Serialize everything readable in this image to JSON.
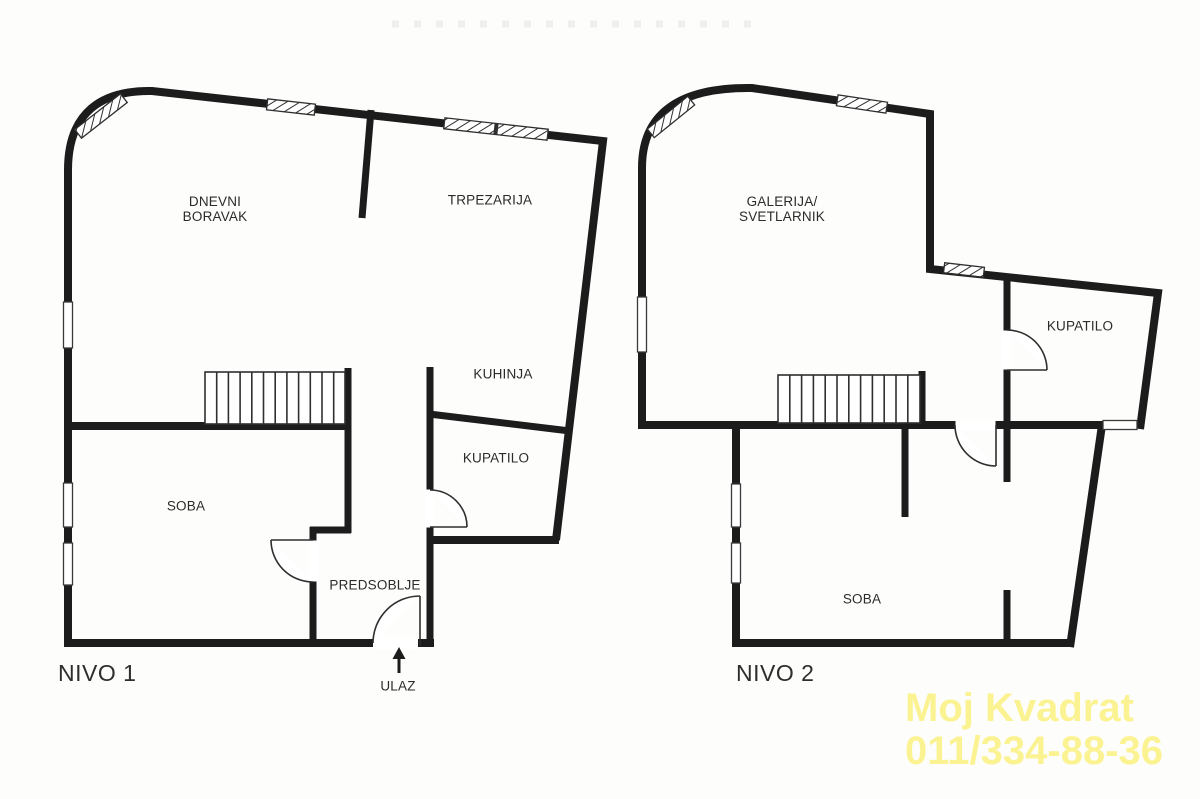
{
  "meta": {
    "background_color": "#fdfdfc",
    "wall_color": "#1c1c1c",
    "label_color": "#2b2b2b",
    "watermark_color": "#fbf392"
  },
  "level1": {
    "title": "NIVO 1",
    "rooms": {
      "living": "DNEVNI\nBORAVAK",
      "dining": "TRPEZARIJA",
      "kitchen": "KUHINJA",
      "bathroom": "KUPATILO",
      "bedroom": "SOBA",
      "hallway": "PREDSOBLJE"
    },
    "entrance_label": "ULAZ"
  },
  "level2": {
    "title": "NIVO 2",
    "rooms": {
      "gallery": "GALERIJA/\nSVETLARNIK",
      "bathroom": "KUPATILO",
      "bedroom": "SOBA"
    }
  },
  "watermark": {
    "line1": "Moj Kvadrat",
    "line2": "011/334-88-36"
  }
}
